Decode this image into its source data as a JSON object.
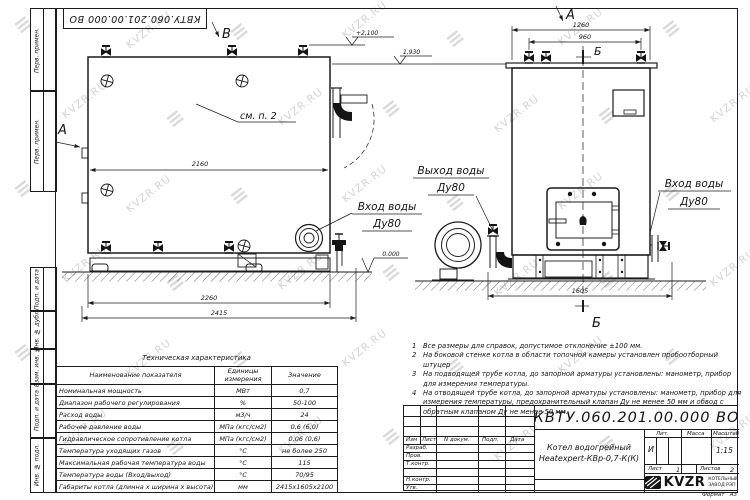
{
  "page": {
    "background": "#ffffff",
    "line_color": "#1c1c1c",
    "watermark_color": "#a8a8a8"
  },
  "watermark": {
    "text": "KVZR.RU",
    "logo_glyph": "≡"
  },
  "corner_stamp": {
    "designation": "КВТУ.060.201.00.000  ВО"
  },
  "margin_cells": [
    {
      "label": "Перв. примен."
    },
    {
      "label": "Перв. примен."
    },
    {
      "label": "Подп. и дата"
    },
    {
      "label": "Инв. № дубл."
    },
    {
      "label": "Взам. инв. №"
    },
    {
      "label": "Подп. и дата"
    },
    {
      "label": "Инв. № подл."
    }
  ],
  "front_view": {
    "view_arrow": "В",
    "section_arrow": "А",
    "see_note": "см. п. 2",
    "dim_inner_width": "2160",
    "dim_skid": "2260",
    "dim_overall": "2415",
    "elev_valves": "+2,100",
    "elev_top": "1,930",
    "elev_ground": "0.000",
    "inlet_line1": "Вход воды",
    "inlet_line2": "Ду80"
  },
  "side_view": {
    "view_arrow": "А",
    "section_top": "Б",
    "section_bottom": "Б",
    "dim_overall": "1260",
    "dim_valves": "960",
    "dim_base": "1605",
    "outlet_line1": "Выход воды",
    "outlet_line2": "Ду80",
    "inlet_line1": "Вход воды",
    "inlet_line2": "Ду80"
  },
  "tech_table": {
    "title": "Техническая характеристика",
    "headers": {
      "name": "Наименование показателя",
      "unit": "Единицы измерения",
      "value": "Значение"
    },
    "rows": [
      {
        "name": "Номинальная мощность",
        "unit": "МВт",
        "value": "0,7"
      },
      {
        "name": "Диапазон рабочего регулирования",
        "unit": "%",
        "value": "50-100"
      },
      {
        "name": "Расход воды",
        "unit": "м3/ч",
        "value": "24"
      },
      {
        "name": "Рабочее давление воды",
        "unit": "МПа (кгс/см2)",
        "value": "0,6 (6,0)"
      },
      {
        "name": "Гидравлическое сопротивление котла",
        "unit": "МПа (кгс/см2)",
        "value": "0,06 (0,6)"
      },
      {
        "name": "Температура уходящих газов",
        "unit": "°С",
        "value": "не более 250"
      },
      {
        "name": "Максимальная рабочая температура воды",
        "unit": "°С",
        "value": "115"
      },
      {
        "name": "Температура воды (Вход/выход)",
        "unit": "°С",
        "value": "70/95"
      },
      {
        "name": "Габариты котла (длинна х ширина х высота)",
        "unit": "мм",
        "value": "2415х1605х2100"
      }
    ]
  },
  "notes": {
    "items": [
      {
        "num": "1",
        "text": "Все размеры для справок, допустимое отклонение ±100 мм."
      },
      {
        "num": "2",
        "text": "На боковой стенке котла в области топочной камеры установлен пробоотборный штуцер"
      },
      {
        "num": "3",
        "text": "На  подводящей трубе котла, до запорной арматуры установлены: манометр, прибор для измерения температуры."
      },
      {
        "num": "4",
        "text": "На отводящей трубе котла, до запорной арматуры установлены: манометр, прибор для измерения температуры, предохранительный клапан Ду не менее 50 мм и обвод с обратным клапаном Ду не менее 50 мм."
      }
    ]
  },
  "title_block": {
    "designation": "КВТУ.060.201.00.000  ВО",
    "change_header": {
      "izm": "Изм",
      "list": "Лист",
      "doc": "N докум.",
      "podp": "Подп.",
      "data": "Дата"
    },
    "signature_rows": {
      "r1": "Разраб.",
      "r2": "Пров.",
      "r3": "Т.контр.",
      "r4": "Н.контр.",
      "r5": "Утв."
    },
    "doc_name_line1": "Котел водогрейный",
    "doc_name_line2": "Heatexpert-КВр-0,7-К(К)",
    "lit_header": "Лит.",
    "lit_value": "И",
    "mass_header": "Масса",
    "scale_header": "Масштаб",
    "scale_value": "1:15",
    "sheet_label": "Лист",
    "sheet_value": "1",
    "sheets_label": "Листов",
    "sheets_value": "2",
    "company_name": "KVZR",
    "company_line1": "КОТЕЛЬНЫЙ",
    "company_line2": "ЗАВОД РЭП",
    "format_label": "Формат",
    "format_value": "А3"
  }
}
